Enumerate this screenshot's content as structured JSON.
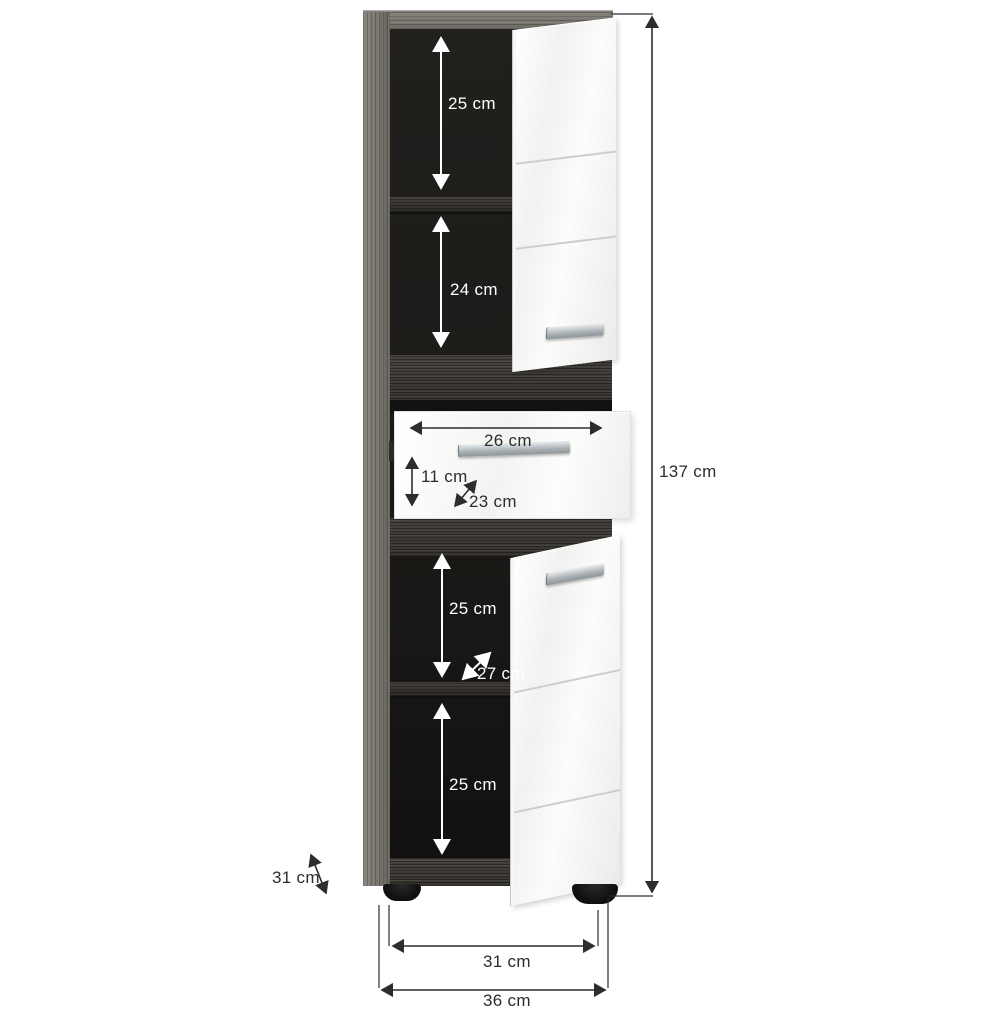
{
  "diagram": {
    "kind": "furniture-dimension-diagram",
    "subject": "tall bathroom cabinet, smoked-oak frame with white gloss fronts, two open doors and one open drawer",
    "units": "cm"
  },
  "dims": {
    "top_compartment_height": "25 cm",
    "second_compartment_height": "24 cm",
    "drawer_width": "26 cm",
    "drawer_front_height": "11 cm",
    "drawer_depth": "23 cm",
    "total_height": "137 cm",
    "third_compartment_height": "25 cm",
    "shelf_depth": "27 cm",
    "bottom_compartment_height": "25 cm",
    "side_depth": "31 cm",
    "feet_span_width": "31 cm",
    "total_width": "36 cm"
  },
  "colors": {
    "background": "#ffffff",
    "frame_wood_light": "#7d7a74",
    "frame_wood_dark": "#3e3b36",
    "interior": "#1d1c1a",
    "front_white": "#f7f7f6",
    "handle_silver": "#aab1b5",
    "feet_black": "#141414",
    "dimension_dark": "#2d2d2d",
    "dimension_light": "#ffffff"
  }
}
